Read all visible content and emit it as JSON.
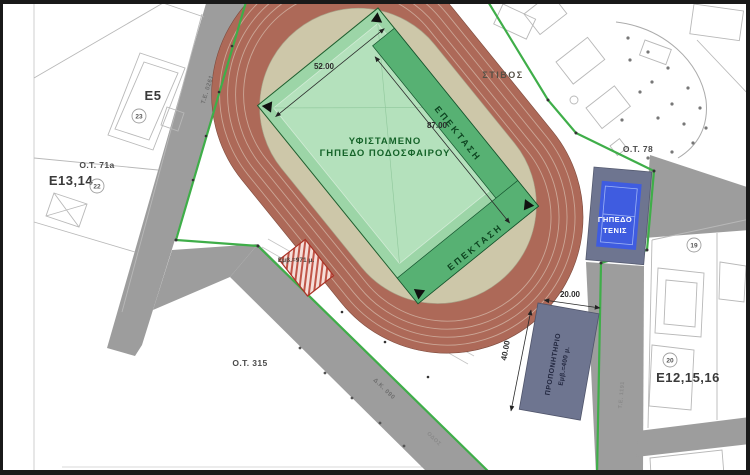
{
  "labels": {
    "existing_field_1": "ΥΦΙΣΤΑΜΕΝΟ",
    "existing_field_2": "ΓΗΠΕΔΟ ΠΟΔΟΣΦΑΙΡΟΥ",
    "extension": "ΕΠΕΚΤΑΣΗ",
    "track": "ΣΤΙΒΟΣ",
    "tennis_1": "ΓΗΠΕΔΟ",
    "tennis_2": "ΤΕΝΙΣ",
    "training_1": "ΠΡΟΠΟΝΗΤΗΡΙΟ",
    "training_2": "Εμβ.=400 μ.",
    "shed_area": "Εμβ.=971 μ.",
    "block_e5": "E5",
    "block_e13_14": "E13,14",
    "block_e12_15_16": "E12,15,16",
    "ot_71a": "O.T. 71a",
    "ot_315": "O.T. 315",
    "ot_78": "O.T. 78",
    "badge_23": "23",
    "badge_22": "22",
    "badge_20": "20",
    "badge_19": "19",
    "road_te_0261": "Τ.Ε. 0261",
    "road_dk_090": "Δ.Κ. 090",
    "road_te_1191": "Τ.Ε. 1191",
    "road_odos": "ΟΔΟΣ"
  },
  "dimensions": {
    "field_width": "52.00",
    "field_length": "87.00",
    "training_width": "20.00",
    "training_depth": "40.00"
  },
  "colors": {
    "track": "#ad6958",
    "track_ring": "#cdc7a9",
    "field": "#9cd5a7",
    "field_inner": "#bce6c3",
    "extension_green": "#57b173",
    "road": "#9d9d9d",
    "boundary_green": "#3fae49",
    "court_blue": "#3f5ce0",
    "slate_block": "#6e7590",
    "hatch_red": "#c05548"
  }
}
